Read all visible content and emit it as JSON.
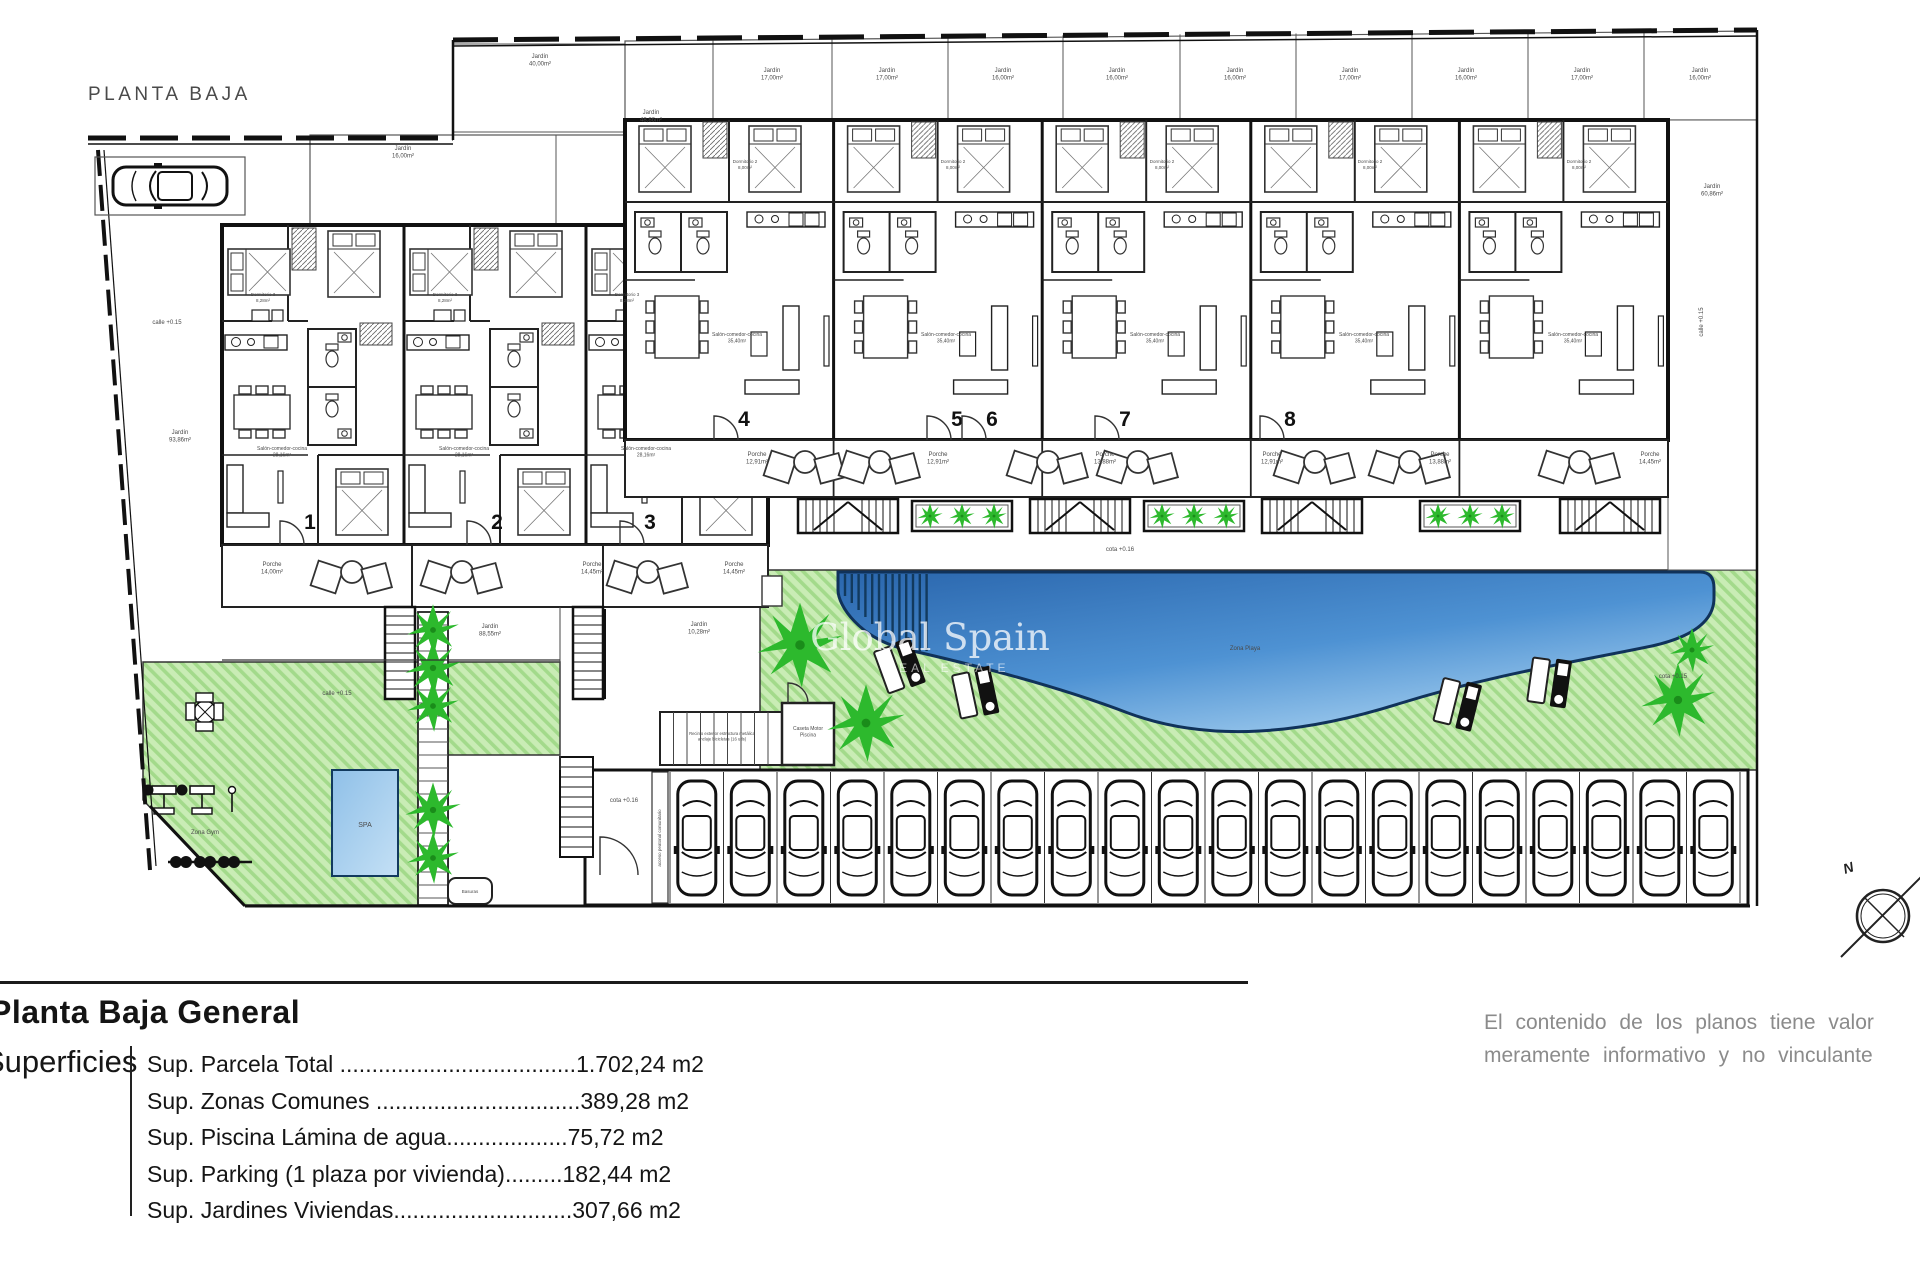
{
  "plan": {
    "drawing_title": "PLANTA BAJA",
    "watermark": {
      "brand": "Global Spain",
      "tagline": "REAL ESTATE"
    },
    "compass_north": "N",
    "units": [
      {
        "n": "1",
        "x": 310,
        "y": 529
      },
      {
        "n": "2",
        "x": 497,
        "y": 529
      },
      {
        "n": "3",
        "x": 650,
        "y": 529
      },
      {
        "n": "4",
        "x": 744,
        "y": 426
      },
      {
        "n": "5",
        "x": 957,
        "y": 426
      },
      {
        "n": "6",
        "x": 992,
        "y": 426
      },
      {
        "n": "7",
        "x": 1125,
        "y": 426
      },
      {
        "n": "8",
        "x": 1290,
        "y": 426
      }
    ],
    "parking": {
      "stall_count": 20
    },
    "colors": {
      "grass_base": "#c9ecb5",
      "grass_stripe": "#a3da8b",
      "palm": "#2db92d",
      "pool_dark": "#2a66ad",
      "pool_light": "#a9d2f1",
      "spa_light": "#c4e0f5",
      "spa_dark": "#8fc0e8",
      "wall": "#111111",
      "label_gray": "#4a4a4a"
    },
    "labels": [
      {
        "t": "Jardín\n40,00m²",
        "x": 540,
        "y": 58
      },
      {
        "t": "Jardín\n17,00m²",
        "x": 772,
        "y": 72
      },
      {
        "t": "Jardín\n17,00m²",
        "x": 887,
        "y": 72
      },
      {
        "t": "Jardín\n16,00m²",
        "x": 1003,
        "y": 72
      },
      {
        "t": "Jardín\n16,00m²",
        "x": 1117,
        "y": 72
      },
      {
        "t": "Jardín\n16,00m²",
        "x": 1235,
        "y": 72
      },
      {
        "t": "Jardín\n17,00m²",
        "x": 1350,
        "y": 72
      },
      {
        "t": "Jardín\n16,00m²",
        "x": 1466,
        "y": 72
      },
      {
        "t": "Jardín\n17,00m²",
        "x": 1582,
        "y": 72
      },
      {
        "t": "Jardín\n16,00m²",
        "x": 1700,
        "y": 72
      },
      {
        "t": "Jardín\n48,86m²",
        "x": 651,
        "y": 114
      },
      {
        "t": "Jardín\n16,00m²",
        "x": 403,
        "y": 150
      },
      {
        "t": "Jardín\n60,86m²",
        "x": 1712,
        "y": 188
      },
      {
        "t": "calle +0.15",
        "x": 167,
        "y": 324
      },
      {
        "t": "calle +0.15",
        "x": 1703,
        "y": 322,
        "r": -90
      },
      {
        "t": "Jardín\n93,86m²",
        "x": 180,
        "y": 434
      },
      {
        "t": "Porche\n14,00m²",
        "x": 272,
        "y": 566
      },
      {
        "t": "Porche\n14,45m²",
        "x": 592,
        "y": 566
      },
      {
        "t": "Porche\n14,45m²",
        "x": 734,
        "y": 566
      },
      {
        "t": "Porche\n12,91m²",
        "x": 757,
        "y": 456
      },
      {
        "t": "Porche\n12,91m²",
        "x": 938,
        "y": 456
      },
      {
        "t": "Porche\n13,88m²",
        "x": 1105,
        "y": 456
      },
      {
        "t": "Porche\n12,91m²",
        "x": 1272,
        "y": 456
      },
      {
        "t": "Porche\n13,88m²",
        "x": 1440,
        "y": 456
      },
      {
        "t": "Porche\n14,45m²",
        "x": 1650,
        "y": 456
      },
      {
        "t": "Jardín\n88,55m²",
        "x": 490,
        "y": 628
      },
      {
        "t": "Jardín\n10,28m²",
        "x": 699,
        "y": 626
      },
      {
        "t": "calle +0.15",
        "x": 337,
        "y": 695
      },
      {
        "t": "cota +0.16",
        "x": 1120,
        "y": 551
      },
      {
        "t": "cota +0.16",
        "x": 624,
        "y": 802
      },
      {
        "t": "cota +0.15",
        "x": 1673,
        "y": 678
      },
      {
        "t": "Salón-comedor-cocina\n28,16m²",
        "x": 282,
        "y": 450,
        "s": 5
      },
      {
        "t": "Salón-comedor-cocina\n28,16m²",
        "x": 464,
        "y": 450,
        "s": 5
      },
      {
        "t": "Salón-comedor-cocina\n28,16m²",
        "x": 646,
        "y": 450,
        "s": 5
      },
      {
        "t": "Salón-comedor-cocina\n35,40m²",
        "x": 737,
        "y": 336,
        "s": 5
      },
      {
        "t": "Salón-comedor-cocina\n35,40m²",
        "x": 946,
        "y": 336,
        "s": 5
      },
      {
        "t": "Salón-comedor-cocina\n35,40m²",
        "x": 1155,
        "y": 336,
        "s": 5
      },
      {
        "t": "Salón-comedor-cocina\n35,40m²",
        "x": 1364,
        "y": 336,
        "s": 5
      },
      {
        "t": "Salón-comedor-cocina\n35,40m²",
        "x": 1573,
        "y": 336,
        "s": 5
      },
      {
        "t": "Dormitorio 3\n8,28m²",
        "x": 263,
        "y": 296,
        "s": 4.5
      },
      {
        "t": "Dormitorio 3\n8,28m²",
        "x": 445,
        "y": 296,
        "s": 4.5
      },
      {
        "t": "Dormitorio 3\n8,28m²",
        "x": 627,
        "y": 296,
        "s": 4.5
      },
      {
        "t": "Dormitorio 2\n8,00m²",
        "x": 745,
        "y": 163,
        "s": 4.5
      },
      {
        "t": "Dormitorio 2\n8,00m²",
        "x": 953,
        "y": 163,
        "s": 4.5
      },
      {
        "t": "Dormitorio 2\n8,00m²",
        "x": 1162,
        "y": 163,
        "s": 4.5
      },
      {
        "t": "Dormitorio 2\n8,00m²",
        "x": 1370,
        "y": 163,
        "s": 4.5
      },
      {
        "t": "Dormitorio 2\n8,00m²",
        "x": 1579,
        "y": 163,
        "s": 4.5
      },
      {
        "t": "Zona Playa",
        "x": 1245,
        "y": 650,
        "c": "#35608c"
      },
      {
        "t": "SPA",
        "x": 365,
        "y": 827,
        "s": 7,
        "c": "#2c5a80"
      },
      {
        "t": "Zona Gym",
        "x": 205,
        "y": 834
      },
      {
        "t": "Caseta Motor\nPiscina",
        "x": 808,
        "y": 730,
        "s": 5
      },
      {
        "t": "Recinto exterior estructura metálica\nanclaje bicicletas (16 uds)",
        "x": 722,
        "y": 735,
        "s": 4.2
      },
      {
        "t": "Basuras",
        "x": 470,
        "y": 893,
        "s": 4.5
      },
      {
        "t": "acceso peatonal comunitario",
        "x": 661,
        "y": 838,
        "s": 4.5,
        "r": -90
      }
    ]
  },
  "title_block": {
    "title": "Planta Baja General",
    "section_label": "Superficies",
    "rows": [
      "Sup. Parcela Total .....................................1.702,24 m2",
      "Sup. Zonas Comunes ................................389,28 m2",
      "Sup. Piscina Lámina de agua...................75,72 m2",
      "Sup. Parking (1 plaza por vivienda).........182,44 m2",
      "Sup. Jardines Viviendas............................307,66 m2"
    ]
  },
  "disclaimer": {
    "line1": "El contenido de los planos tiene valor",
    "line2": "meramente informativo y no vinculante"
  }
}
